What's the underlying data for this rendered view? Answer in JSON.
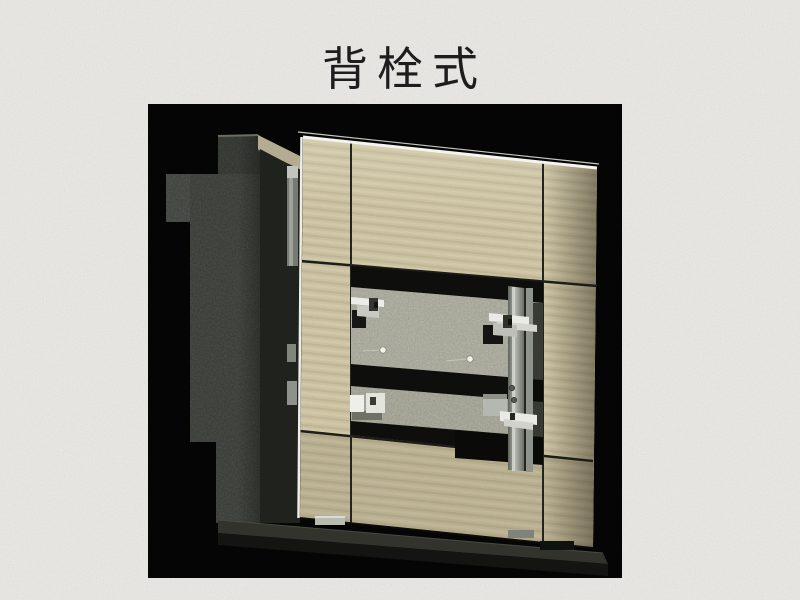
{
  "slide": {
    "title": "背栓式",
    "background_color": "#eae9e5",
    "title_color": "#1d1d1d"
  },
  "figure": {
    "alt": "石材幕墙背栓式安装节点三维示意图：混凝土墙体、背栓锚固件、竖向铝龙骨与米黄色石材面板剖切展示",
    "frame_color": "#050505",
    "stone_color": "#cbc19f",
    "concrete_color": "#353832",
    "stone_back_color": "#a5a595",
    "anchor_color": "#e9e9e5",
    "rail_color": "#9ba098"
  }
}
